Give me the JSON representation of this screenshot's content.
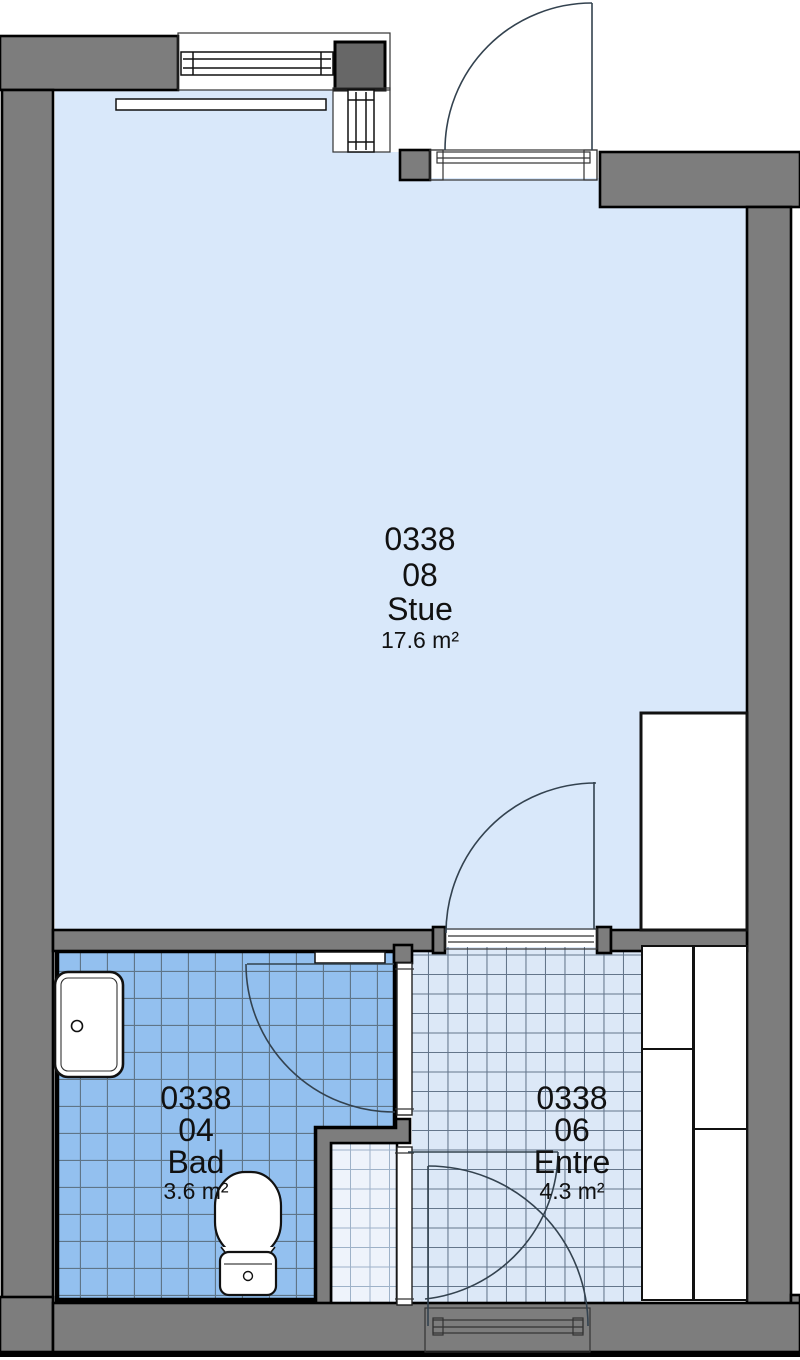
{
  "plan": {
    "rooms": {
      "stue": {
        "unit": "0338",
        "number": "08",
        "name": "Stue",
        "area": "17.6 m²"
      },
      "bad": {
        "unit": "0338",
        "number": "04",
        "name": "Bad",
        "area": "3.6 m²"
      },
      "entre": {
        "unit": "0338",
        "number": "06",
        "name": "Entre",
        "area": "4.3 m²"
      }
    },
    "colors": {
      "wall": "#7d7d7d",
      "wall_dark": "#676767",
      "outline": "#000000",
      "stue_floor": "#d9e8fa",
      "bad_floor": "#93c0ef",
      "bad_grid": "#5f7588",
      "entre_floor": "#dce8f7",
      "entre_grid": "#64768b",
      "nook_floor": "#eef3fb",
      "nook_grid": "#9eb2c8",
      "door_line": "#33424f"
    },
    "fixtures": [
      "toilet",
      "washbasin",
      "wardrobe",
      "radiator",
      "window",
      "door-swing"
    ]
  }
}
